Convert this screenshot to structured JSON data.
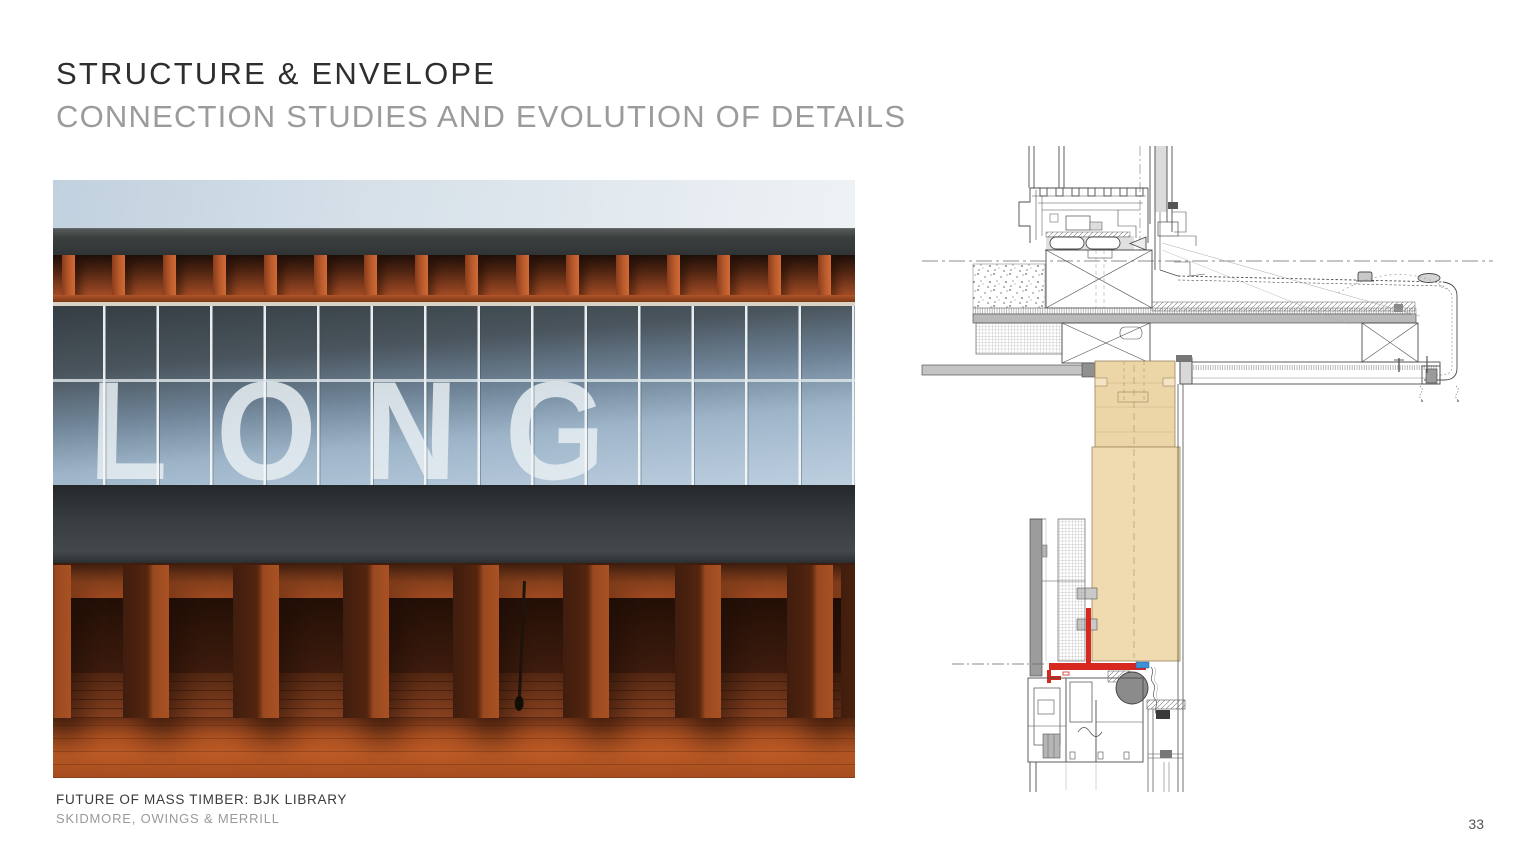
{
  "slide": {
    "title": "STRUCTURE & ENVELOPE",
    "subtitle": "CONNECTION STUDIES AND EVOLUTION OF DETAILS",
    "footer_project": "FUTURE OF MASS TIMBER: BJK LIBRARY",
    "footer_firm": "SKIDMORE, OWINGS & MERRILL",
    "page_number": "33"
  },
  "photo": {
    "glass_signage_text": "LONG"
  },
  "drawing": {
    "timber_color": "#ecd5a6",
    "highlight_red": "#d6281e",
    "shim_blue": "#3f8fd4",
    "gasket_gray": "#8b8b8b"
  }
}
